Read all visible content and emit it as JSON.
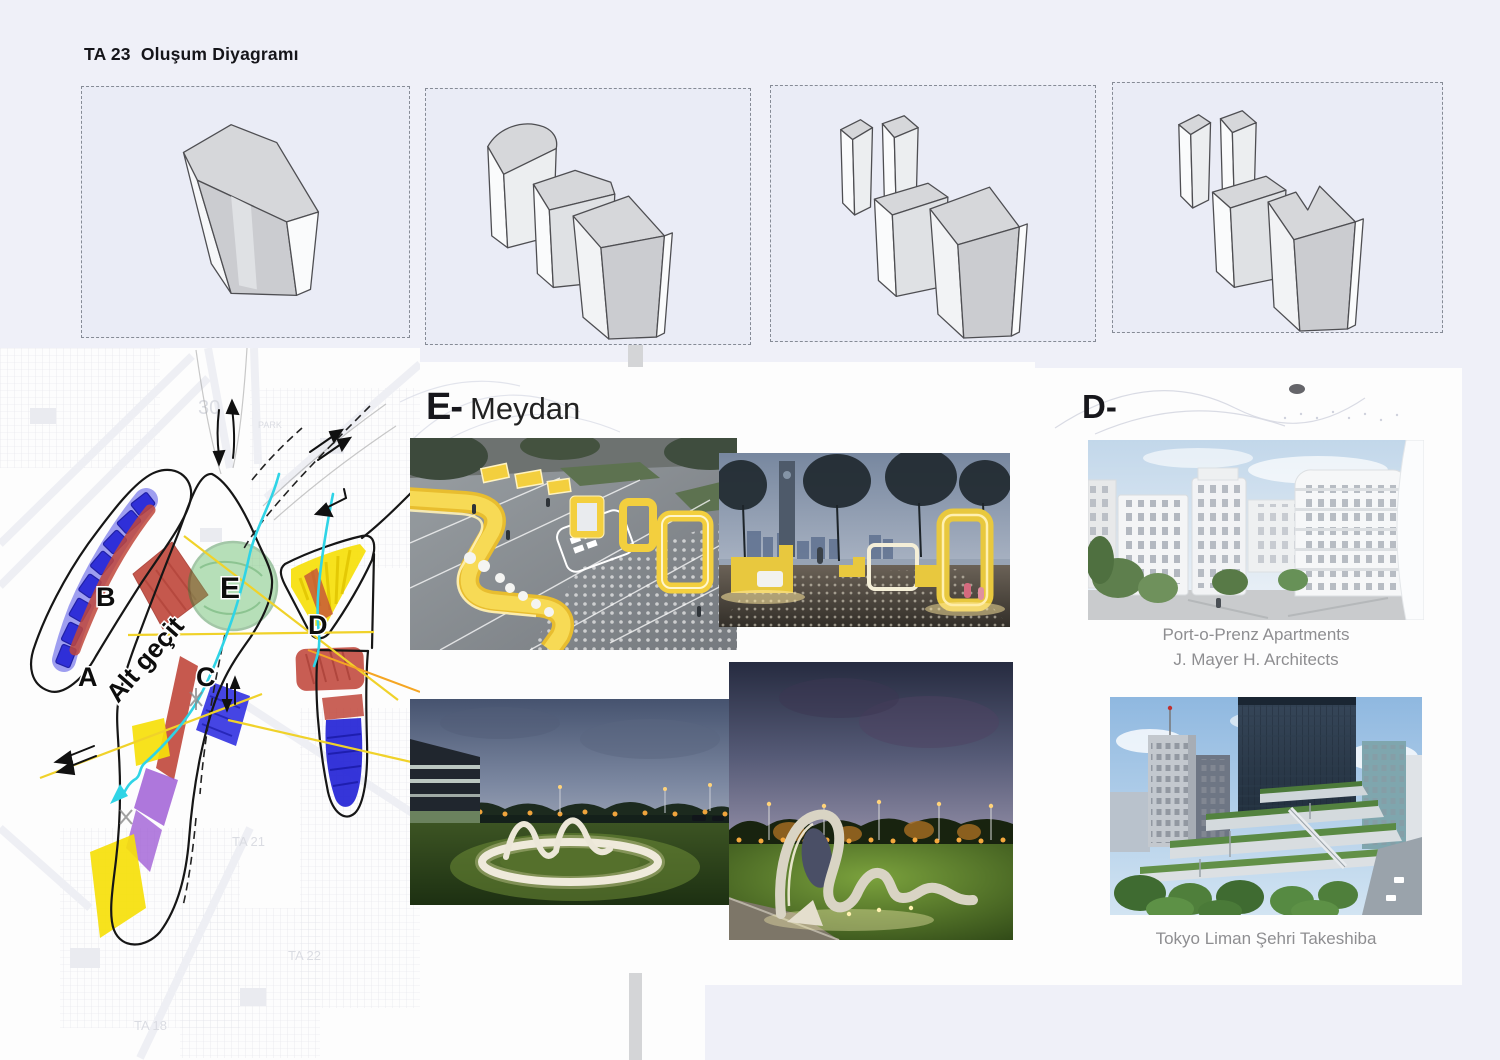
{
  "page": {
    "title": "TA 23  Oluşum Diyagramı",
    "background_color": "#eff0f8"
  },
  "map": {
    "zone_labels": [
      "A",
      "B",
      "C",
      "D",
      "E"
    ],
    "road_label": "Alt geçit",
    "faint_labels": [
      "30",
      "PARK",
      "TA 21",
      "TA 22",
      "TA 18"
    ],
    "colors": {
      "blue": "#2b2be0",
      "red": "#c0473b",
      "green": "#57b65b",
      "yellow": "#f6df0a",
      "purple": "#a05fd6",
      "cyan": "#2fd4e6",
      "orange": "#f5a623"
    }
  },
  "section_e": {
    "heading_bold": "E-",
    "heading_text": "Meydan"
  },
  "section_d": {
    "heading_bold": "D-",
    "captions": {
      "apartments_line1": "Port-o-Prenz Apartments",
      "apartments_line2": "J. Mayer H. Architects",
      "tokyo": "Tokyo Liman Şehri Takeshiba"
    }
  }
}
